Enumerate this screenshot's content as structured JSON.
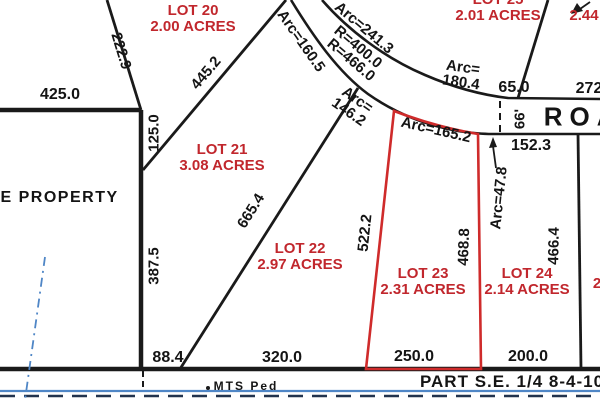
{
  "colors": {
    "boundary_black": "#1a1a1a",
    "lot_label_red": "#c1272d",
    "highlight_outline_red": "#cf2b2b",
    "section_line_blue": "#4f86c6"
  },
  "lots": {
    "lot20": {
      "name": "LOT 20",
      "acres": "2.00 ACRES"
    },
    "lot21": {
      "name": "LOT 21",
      "acres": "3.08 ACRES"
    },
    "lot22": {
      "name": "LOT 22",
      "acres": "2.97 ACRES"
    },
    "lot23": {
      "name": "LOT 23",
      "acres": "2.31 ACRES",
      "highlighted": true
    },
    "lot24": {
      "name": "LOT 24",
      "acres": "2.14 ACRES"
    },
    "lot25": {
      "name": "LOT 25",
      "acres": "2.01 ACRES"
    },
    "lot_ne_partial": {
      "acres": "2.44"
    },
    "lot_east_partial": {
      "label": "2"
    }
  },
  "dimensions": {
    "top_left": "425.0",
    "lot20_west": "222.9",
    "lot20_21": "445.2",
    "west_upper": "125.0",
    "west_lower": "387.5",
    "lot21_22": "665.4",
    "lot22_23": "522.2",
    "lot23_east": "468.8",
    "lot24_east": "466.4",
    "bottom_1": "88.4",
    "bottom_2": "320.0",
    "bottom_3": "250.0",
    "bottom_4": "200.0",
    "lot24_north": "152.3",
    "north_65": "65.0",
    "north_272": "272"
  },
  "road": {
    "name": "ROAD",
    "width": "66'",
    "radius_outer": "R=400.0",
    "radius_inner": "R=466.0",
    "arc_north": "Arc=241.3",
    "arc_lot20": "Arc=160.5",
    "arc_lot21_line1": "Arc=",
    "arc_lot21_line2": "146.2",
    "arc_lot25_line1": "Arc=",
    "arc_lot25_line2": "180.4",
    "arc_lot23": "Arc=165.2",
    "arc_small": "Arc=47.8"
  },
  "annotations": {
    "state_property": "ATE PROPERTY",
    "monument": "MTS Ped",
    "section_label": "PART S.E. 1/4 8-4-10"
  }
}
